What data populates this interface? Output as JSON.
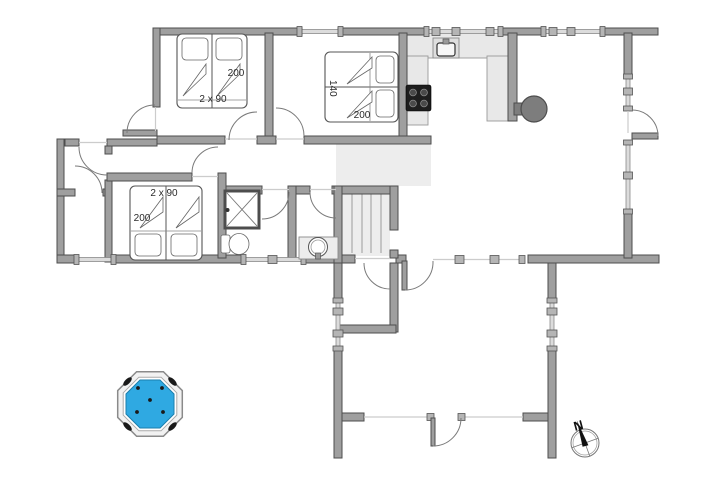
{
  "floor_plan": {
    "rooms": {
      "bedroom_top_left": {
        "bed_count_label": "2 x 90",
        "bed_length_label": "200"
      },
      "bedroom_top_middle": {
        "bed_width_label": "140",
        "bed_length_label": "200"
      },
      "bedroom_bottom_left": {
        "bed_count_label": "2 x 90",
        "bed_length_label": "200"
      }
    },
    "compass": {
      "north_label": "N"
    },
    "colors": {
      "wall": "#9f9f9f",
      "wall_outline": "#4d4d4d",
      "secondary_floor": "#ededed",
      "kitchen_counter": "#e8e8e8",
      "hot_tub_water": "#2fa9e2",
      "hot_tub_water_outline": "#1b7fae",
      "cooktop": "#1e1e1e",
      "wood_stove": "#7d7d7d"
    },
    "fixtures": [
      "twin-beds-top-left",
      "double-bed-140",
      "twin-beds-bottom-left",
      "kitchen-sink",
      "cooktop",
      "wood-burning-stove",
      "shower",
      "toilet",
      "washbasin",
      "sauna-slats",
      "hot-tub",
      "compass-rose"
    ]
  }
}
